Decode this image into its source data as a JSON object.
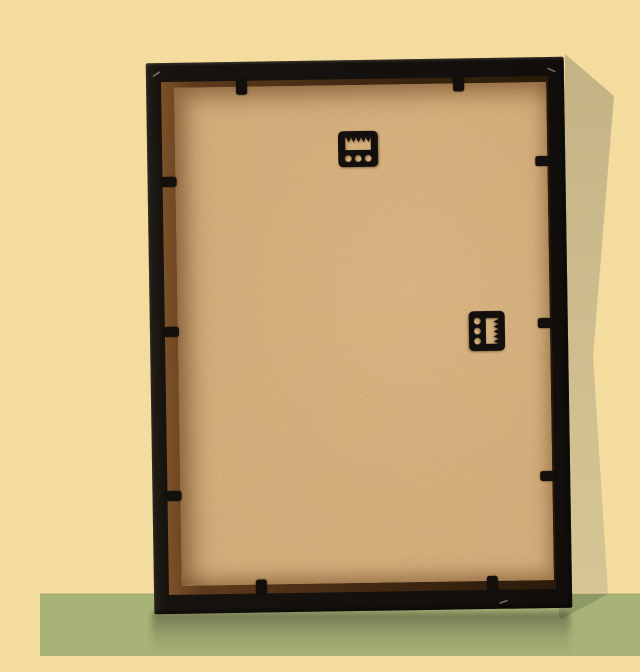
{
  "scene": {
    "description": "Rear view of a black picture frame with a tan MDF hardboard backing, leaning against a pale yellow wall on an olive green floor, casting a soft shadow to its right.",
    "objects": {
      "wall": "pale yellow wall",
      "floor": "olive green glossy floor with faint reflection",
      "frame": "black picture frame, back side",
      "backing_board": "tan MDF backing panel with mottled texture",
      "top_hanger": "black sawtooth hanger, horizontal, upper center",
      "side_hanger": "black sawtooth hanger, vertical, right of center",
      "clips": "black retaining tabs holding the backing"
    },
    "counts": {
      "sawtooth_hangers": 2,
      "clips_top": 2,
      "clips_bottom": 2,
      "clips_left": 3,
      "clips_right": 3
    }
  },
  "colors": {
    "wall": "#f4dc9e",
    "wallShadow": "#cbbb8c",
    "floor": "#a8b377",
    "floorShadow": "#8e9a66",
    "frameBlack": "#17130f",
    "recess": "#5e3a1c",
    "backing": "#cfa269",
    "hardware": "#120f0c"
  }
}
